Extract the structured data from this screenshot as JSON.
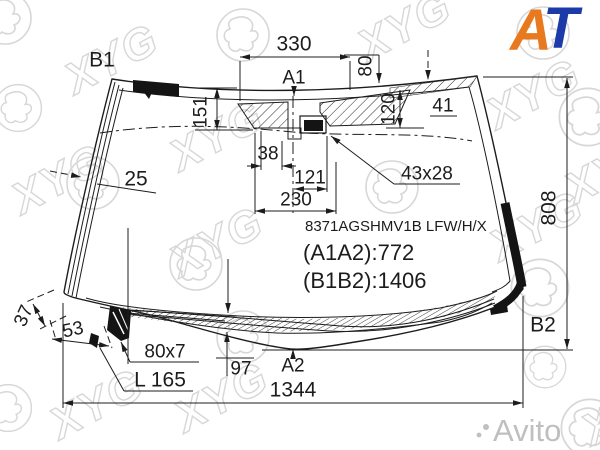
{
  "branding": {
    "xyg_text": "XYG",
    "watermark_color": "#d7d7d7",
    "at_logo": {
      "a": "A",
      "t": "T",
      "a_color": "#E8791E",
      "t_color": "#1D3BA8"
    },
    "avito_text": "Avito"
  },
  "part": {
    "code": "8371AGSHMV1B LFW/H/X",
    "a1a2": "(A1A2):772",
    "b1b2": "(B1B2):1406"
  },
  "markers": {
    "b1": "B1",
    "a1": "A1",
    "a2": "A2",
    "b2": "B2"
  },
  "dims": {
    "top_width": "330",
    "top_offset": "80",
    "left_height": "151",
    "edge_offset": "41",
    "center_height": "120",
    "tab_width": "38",
    "sensor_offset": "121",
    "mount_width": "230",
    "sensor_size": "43x28",
    "right_height": "808",
    "moulding_left": "25",
    "moulding_bottom": "37",
    "corner_offset": "53",
    "heater_size": "80x7",
    "heater_length": "L 165",
    "band_height": "97",
    "bottom_width": "1344"
  }
}
